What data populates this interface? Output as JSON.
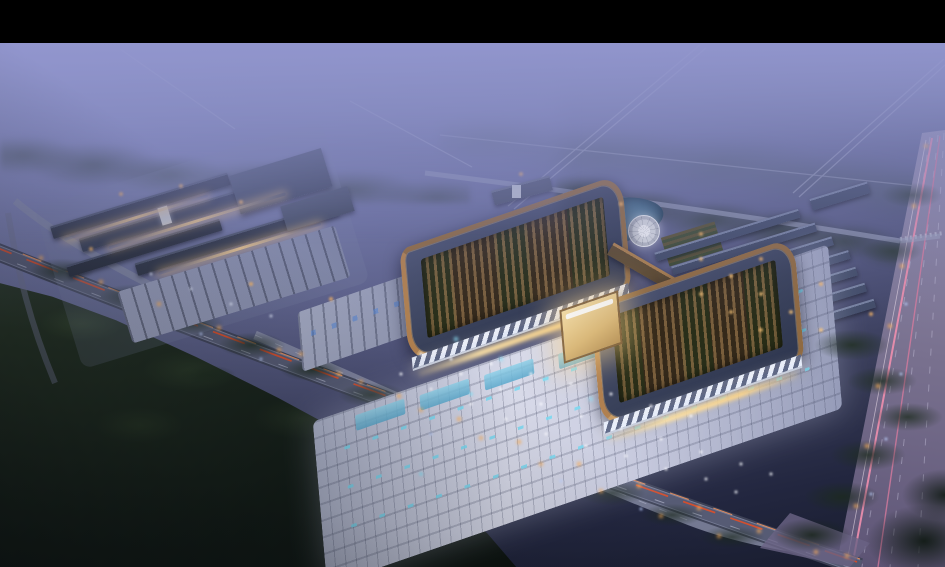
{
  "scene": {
    "kind": "aerial-architectural-rendering",
    "setting": "dusk, misty",
    "subject": "campus with twin curved-bronze-roof pavilions, illuminated plaza parking, market complex, pond with round fountain, row sheds, highway with tail-light streaks and arterial road"
  },
  "palette": {
    "letterbox": "#000000",
    "haze_top": "#8e92cb",
    "dusk_ground": "#5a5e86",
    "forest_dark": "#141d18",
    "roof_slate": "#39415a",
    "roof_bronze": "#8f6a42",
    "courtyard_brown": "#5e4a30",
    "courtyard_green": "#47572e",
    "glow_warm": "#ffe3a6",
    "facade_warm": "#e8c48d",
    "plaza_light": "#d8dae9",
    "plaza_mid": "#959bb8",
    "cyan_marker": "#7fd8f0",
    "pond": "#4f7693",
    "pond_deep": "#2f4f6a",
    "fountain": "#d4d7dd",
    "shed_roof": "#424c68",
    "shed_ridge": "#76819f",
    "left_roof": "#303748",
    "taillight_red": "#d94f2b",
    "taillight_orange": "#ff9a5e",
    "streak_pink": "#ef8fae",
    "road_main": "#565b74",
    "road_light": "#8a8fa8",
    "light_orange": "#ffb058"
  }
}
